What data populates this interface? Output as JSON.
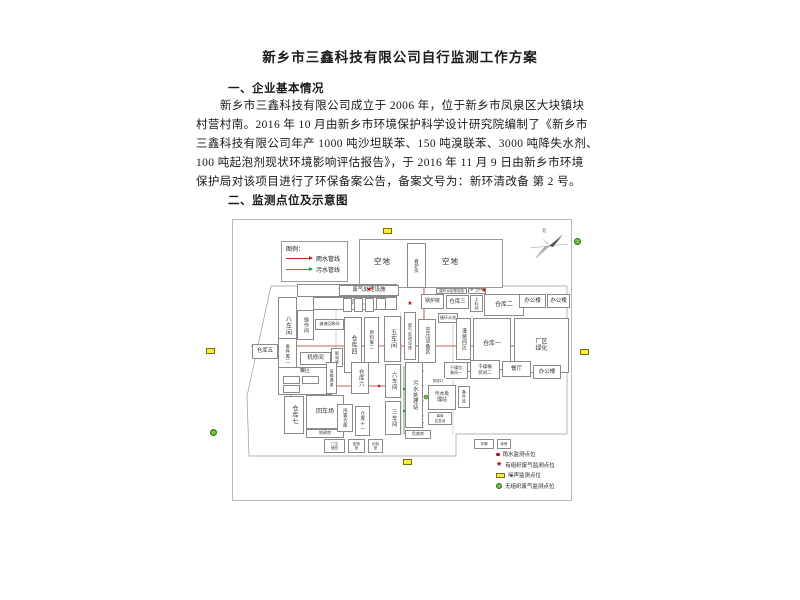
{
  "document": {
    "title": "新乡市三鑫科技有限公司自行监测工作方案",
    "section1_heading": "一、企业基本情况",
    "paragraph_lines": [
      "新乡市三鑫科技有限公司成立于 2006 年，位于新乡市凤泉区大块镇块",
      "村营村南。2016 年 10 月由新乡市环境保护科学设计研究院编制了《新乡市",
      "三鑫科技有限公司年产 1000 吨沙坦联苯、150 吨溴联苯、3000 吨降失水剂、",
      "100 吨起泡剂现状环境影响评估报告》，于 2016 年 11 月 9 日由新乡市环境",
      "保护局对该项目进行了环保备案公告，备案文号为：新环清改备 第 2 号。"
    ],
    "section2_heading": "二、监测点位及示意图"
  },
  "diagram": {
    "colors": {
      "rain": "#bb2b23",
      "sewage": "#2f9e44",
      "grid": "#a9a9a9",
      "boundary": "#9a9a9a"
    },
    "legend": {
      "title": "图例：",
      "items": [
        {
          "label": "雨水管线",
          "color": "#bb2b23"
        },
        {
          "label": "污水管线",
          "color": "#2f9e44"
        }
      ]
    },
    "north_label": "北",
    "top_blocks": {
      "left": "空地",
      "hut": "看护房",
      "right": "空地"
    },
    "plan_boxes": [
      {
        "label": "仓库十",
        "x": 64,
        "y": 64,
        "w": 100,
        "h": 13,
        "fs": 6
      },
      {
        "label": "仓库九",
        "x": 80,
        "y": 77,
        "w": 84,
        "h": 13,
        "fs": 6
      },
      {
        "label": "八车间",
        "x": 45,
        "y": 77,
        "w": 19,
        "h": 57,
        "v": 1,
        "fs": 6
      },
      {
        "label": "操作间",
        "x": 64,
        "y": 90,
        "w": 17,
        "h": 30,
        "v": 1,
        "fs": 5
      },
      {
        "label": "碱液回收间",
        "x": 82,
        "y": 99,
        "w": 29,
        "h": 11,
        "fs": 4
      },
      {
        "label": "仓库五",
        "x": 19,
        "y": 124,
        "w": 26,
        "h": 15,
        "fs": 5.5
      },
      {
        "label": "备件库二",
        "x": 45,
        "y": 118,
        "w": 19,
        "h": 31,
        "v": 1,
        "fs": 4.5
      },
      {
        "label": "机修间",
        "x": 67,
        "y": 132,
        "w": 31,
        "h": 13,
        "fs": 5.5
      },
      {
        "label": "配电室",
        "x": 98,
        "y": 128,
        "w": 12,
        "h": 19,
        "v": 1,
        "fs": 4
      },
      {
        "label": "罐区",
        "x": 45,
        "y": 147,
        "w": 54,
        "h": 28,
        "fs": 5,
        "ta": 1
      },
      {
        "label": "",
        "x": 50,
        "y": 156,
        "w": 17,
        "h": 8
      },
      {
        "label": "",
        "x": 69,
        "y": 156,
        "w": 17,
        "h": 8
      },
      {
        "label": "",
        "x": 50,
        "y": 165,
        "w": 17,
        "h": 8
      },
      {
        "label": "仓库七",
        "x": 51,
        "y": 176,
        "w": 20,
        "h": 38,
        "v": 1,
        "fs": 6
      },
      {
        "label": "回车场",
        "x": 73,
        "y": 175,
        "w": 38,
        "h": 34,
        "fs": 6
      },
      {
        "label": "地磅房",
        "x": 73,
        "y": 209,
        "w": 38,
        "h": 9,
        "fs": 4
      },
      {
        "label": "废气处理设施",
        "x": 106,
        "y": 65,
        "w": 60,
        "h": 11,
        "fs": 5.5
      },
      {
        "label": "",
        "x": 110,
        "y": 78,
        "w": 9,
        "h": 14
      },
      {
        "label": "",
        "x": 121,
        "y": 78,
        "w": 9,
        "h": 14
      },
      {
        "label": "",
        "x": 132,
        "y": 78,
        "w": 9,
        "h": 14
      },
      {
        "label": "",
        "x": 143,
        "y": 78,
        "w": 10,
        "h": 12
      },
      {
        "label": "仓库四",
        "x": 111,
        "y": 97,
        "w": 18,
        "h": 56,
        "v": 1,
        "fs": 6
      },
      {
        "label": "原料库二",
        "x": 131,
        "y": 97,
        "w": 15,
        "h": 46,
        "v": 1,
        "fs": 4.5
      },
      {
        "label": "五车间",
        "x": 151,
        "y": 96,
        "w": 17,
        "h": 46,
        "v": 1,
        "fs": 6
      },
      {
        "label": "废气处理设施",
        "x": 171,
        "y": 92,
        "w": 12,
        "h": 48,
        "v": 1,
        "fs": 4
      },
      {
        "label": "锅炉房",
        "x": 188,
        "y": 74,
        "w": 23,
        "h": 15,
        "fs": 5
      },
      {
        "label": "仓库三",
        "x": 213,
        "y": 75,
        "w": 23,
        "h": 14,
        "fs": 5.5
      },
      {
        "label": "上料间",
        "x": 237,
        "y": 75,
        "w": 13,
        "h": 17,
        "v": 1,
        "fs": 4
      },
      {
        "label": "仓库二",
        "x": 251,
        "y": 74,
        "w": 40,
        "h": 22,
        "fs": 6
      },
      {
        "label": "办公楼",
        "x": 286,
        "y": 74,
        "w": 27,
        "h": 14,
        "fs": 5.5
      },
      {
        "label": "办公楼",
        "x": 314,
        "y": 74,
        "w": 23,
        "h": 14,
        "fs": 5.5
      },
      {
        "label": "循环水处理设施",
        "x": 203,
        "y": 68,
        "w": 31,
        "h": 6,
        "fs": 3.5
      },
      {
        "label": "废气排放口",
        "x": 235,
        "y": 68,
        "w": 18,
        "h": 6,
        "fs": 3.5
      },
      {
        "label": "空压设备区",
        "x": 185,
        "y": 99,
        "w": 18,
        "h": 44,
        "v": 1,
        "fs": 5
      },
      {
        "label": "循环水池",
        "x": 205,
        "y": 93,
        "w": 20,
        "h": 10,
        "fs": 4
      },
      {
        "label": "灌装间区",
        "x": 223,
        "y": 98,
        "w": 15,
        "h": 42,
        "v": 1,
        "fs": 5
      },
      {
        "label": "",
        "x": 223,
        "y": 142,
        "w": 15,
        "h": 10
      },
      {
        "label": "仓库一",
        "x": 240,
        "y": 98,
        "w": 38,
        "h": 52,
        "fs": 6
      },
      {
        "label": "厂区\n绿化",
        "x": 281,
        "y": 98,
        "w": 55,
        "h": 55,
        "fs": 6
      },
      {
        "label": "干燥包\n装间一",
        "x": 211,
        "y": 142,
        "w": 24,
        "h": 17,
        "fs": 4
      },
      {
        "label": "干燥桶\n装间二",
        "x": 237,
        "y": 140,
        "w": 30,
        "h": 19,
        "fs": 4.5
      },
      {
        "label": "餐厅",
        "x": 269,
        "y": 141,
        "w": 29,
        "h": 16,
        "fs": 5.5
      },
      {
        "label": "办公楼",
        "x": 300,
        "y": 145,
        "w": 28,
        "h": 14,
        "fs": 5.5
      },
      {
        "label": "污水处理站",
        "x": 172,
        "y": 142,
        "w": 18,
        "h": 66,
        "v": 1,
        "fs": 5.5
      },
      {
        "label": "排放口",
        "x": 197,
        "y": 158,
        "w": 16,
        "h": 6,
        "fs": 3.5,
        "nb": 1
      },
      {
        "label": "污水处\n理站",
        "x": 195,
        "y": 165,
        "w": 28,
        "h": 25,
        "fs": 5
      },
      {
        "label": "备件库",
        "x": 225,
        "y": 166,
        "w": 12,
        "h": 22,
        "v": 1,
        "fs": 4
      },
      {
        "label": "事故\n应急池",
        "x": 195,
        "y": 192,
        "w": 24,
        "h": 13,
        "fs": 3.5
      },
      {
        "label": "危废库",
        "x": 172,
        "y": 210,
        "w": 26,
        "h": 9,
        "fs": 4
      },
      {
        "label": "六车间",
        "x": 152,
        "y": 144,
        "w": 16,
        "h": 34,
        "v": 1,
        "fs": 5.5
      },
      {
        "label": "三车间",
        "x": 152,
        "y": 181,
        "w": 16,
        "h": 34,
        "v": 1,
        "fs": 5.5
      },
      {
        "label": "运输通道",
        "x": 93,
        "y": 142,
        "w": 11,
        "h": 32,
        "v": 1,
        "fs": 4
      },
      {
        "label": "仓库六",
        "x": 118,
        "y": 142,
        "w": 18,
        "h": 32,
        "v": 1,
        "fs": 5.5
      },
      {
        "label": "闲置仓库",
        "x": 104,
        "y": 184,
        "w": 16,
        "h": 28,
        "v": 1,
        "fs": 4.5
      },
      {
        "label": "仓库十一",
        "x": 122,
        "y": 186,
        "w": 15,
        "h": 30,
        "v": 1,
        "fs": 4.5
      },
      {
        "label": "门卫\n值班",
        "x": 91,
        "y": 219,
        "w": 21,
        "h": 14,
        "fs": 3.5
      },
      {
        "label": "配电\n室",
        "x": 115,
        "y": 219,
        "w": 17,
        "h": 14,
        "fs": 3.5
      },
      {
        "label": "化验\n室",
        "x": 135,
        "y": 219,
        "w": 15,
        "h": 14,
        "fs": 3.5
      },
      {
        "label": "车棚",
        "x": 241,
        "y": 219,
        "w": 20,
        "h": 10,
        "fs": 3.5
      },
      {
        "label": "库房",
        "x": 264,
        "y": 219,
        "w": 14,
        "h": 10,
        "fs": 3.5
      }
    ],
    "boundary": [
      [
        38,
        66
      ],
      [
        334,
        66
      ],
      [
        334,
        214
      ],
      [
        223,
        214
      ],
      [
        223,
        236
      ],
      [
        16,
        236
      ],
      [
        14,
        176
      ],
      [
        38,
        66
      ]
    ],
    "grid_lines": [
      [
        103,
        64,
        103,
        182
      ],
      [
        168,
        92,
        168,
        214
      ],
      [
        220,
        97,
        220,
        215
      ]
    ],
    "pipes": [
      {
        "c": "rain",
        "pts": [
          [
            191,
            63
          ],
          [
            191,
            126
          ]
        ],
        "dots": [
          [
            191,
            63
          ]
        ]
      },
      {
        "c": "rain",
        "pts": [
          [
            18,
            126
          ],
          [
            332,
            126
          ]
        ],
        "arrow": 1,
        "dots": [
          [
            63,
            126
          ],
          [
            153,
            126
          ],
          [
            233,
            126
          ],
          [
            288,
            126
          ]
        ]
      },
      {
        "c": "rain",
        "pts": [
          [
            53,
            166
          ],
          [
            163,
            166
          ]
        ],
        "arrow": 1,
        "dots": [
          [
            98,
            166
          ],
          [
            146,
            166
          ]
        ]
      },
      {
        "c": "rain",
        "pts": [
          [
            58,
            126
          ],
          [
            58,
            206
          ]
        ],
        "dots": [
          [
            58,
            144
          ],
          [
            58,
            183
          ]
        ]
      },
      {
        "c": "sewage",
        "pts": [
          [
            171,
            146
          ],
          [
            171,
            214
          ],
          [
            195,
            214
          ]
        ],
        "arrow": 1,
        "dots": [
          [
            171,
            169
          ],
          [
            171,
            191
          ]
        ]
      },
      {
        "c": "sewage",
        "pts": [
          [
            189,
            131
          ],
          [
            189,
            205
          ]
        ],
        "arrow": 1,
        "dots": [
          [
            189,
            151
          ],
          [
            189,
            166
          ],
          [
            189,
            181
          ],
          [
            189,
            196
          ]
        ]
      }
    ],
    "stars": [
      [
        136,
        70
      ],
      [
        251,
        71
      ],
      [
        177,
        84
      ]
    ],
    "green_points": [
      [
        193,
        177
      ]
    ],
    "monitor_legend": [
      {
        "symbol": "dot",
        "label": "雨水监测点位"
      },
      {
        "symbol": "star",
        "label": "有组织废气监测点位"
      },
      {
        "symbol": "rect",
        "label": "噪声监测点位"
      },
      {
        "symbol": "circ",
        "label": "无组织废气监测点位"
      }
    ]
  },
  "outside_markers": [
    {
      "type": "rect",
      "x": 206,
      "y": 348
    },
    {
      "type": "rect",
      "x": 580,
      "y": 349
    },
    {
      "type": "rect",
      "x": 383,
      "y": 228
    },
    {
      "type": "rect",
      "x": 403,
      "y": 459
    },
    {
      "type": "circ",
      "x": 210,
      "y": 429
    },
    {
      "type": "circ",
      "x": 574,
      "y": 238
    }
  ]
}
